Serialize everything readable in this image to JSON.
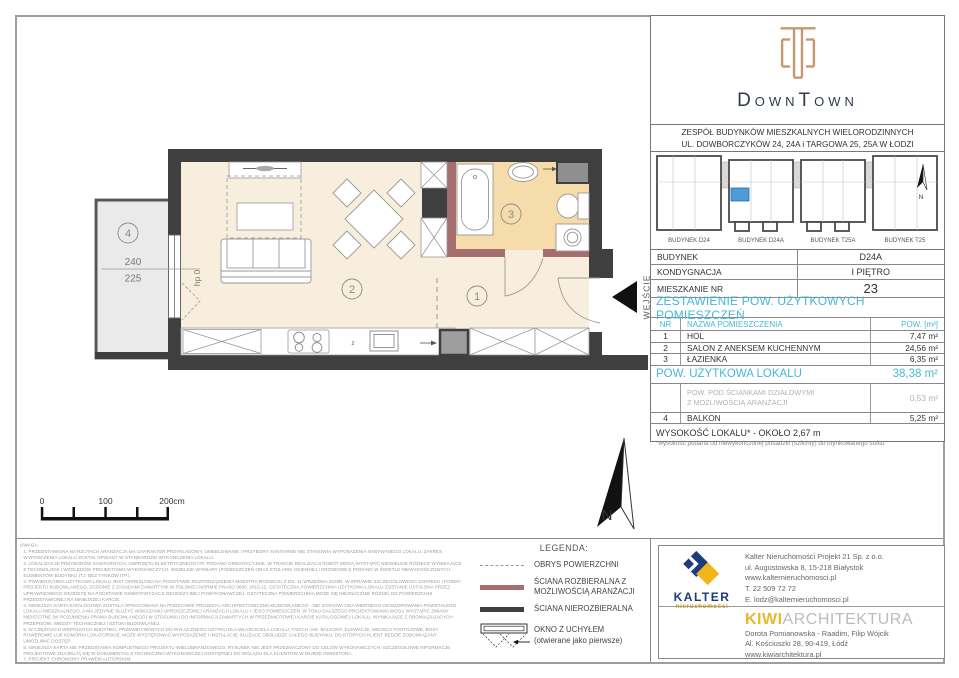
{
  "header": {
    "logo_title": "DownTown",
    "address_line1": "ZESPÓŁ BUDYNKÓW MIESZKALNYCH WIELORODZINNYCH",
    "address_line2": "UL. DOWBORCZYKÓW 24, 24A i TARGOWA 25, 25A W ŁODZI"
  },
  "site_plan": {
    "buildings": [
      {
        "label": "BUDYNEK D24"
      },
      {
        "label": "BUDYNEK D24A"
      },
      {
        "label": "BUDYNEK T25A"
      },
      {
        "label": "BUDYNEK T25"
      }
    ],
    "north_label": "N",
    "highlight_color": "#4f9bd8"
  },
  "unit_info": {
    "rows": [
      {
        "label": "BUDYNEK",
        "value": "D24A"
      },
      {
        "label": "KONDYGNACJA",
        "value": "I PIĘTRO"
      },
      {
        "label": "MIESZKANIE NR",
        "value": "23"
      }
    ]
  },
  "area_table": {
    "title": "ZESTAWIENIE POW. UŻYTKOWYCH POMIESZCZEŃ",
    "col_nr": "NR",
    "col_name": "NAZWA POMIESZCZENIA",
    "col_area": "POW. [m²]",
    "rooms": [
      {
        "nr": "1",
        "name": "HOL",
        "area": "7,47 m²"
      },
      {
        "nr": "2",
        "name": "SALON Z ANEKSEM KUCHENNYM",
        "area": "24,56 m²"
      },
      {
        "nr": "3",
        "name": "ŁAZIENKA",
        "area": "6,35 m²"
      }
    ],
    "total_label": "POW. UŻYTKOWA LOKALU",
    "total_value": "38,38 m²",
    "sub_label_line1": "POW. POD ŚCIANKAMI DZIAŁOWYMI",
    "sub_label_line2": "Z MOŻLIWOŚCIĄ ARANŻACJI",
    "sub_value": "0,53 m²",
    "balkon_nr": "4",
    "balkon_name": "BALKON",
    "balkon_value": "5,25 m²",
    "height_note": "WYSOKOŚĆ LOKALU* - OKOŁO 2,67 m",
    "height_footnote": "*wysokość podana od niewykończonej posadzki (szlichty) do otynkowanego sufitu"
  },
  "plan": {
    "room_hall": "1",
    "room_living": "2",
    "room_bath": "3",
    "room_balcony": "4",
    "entrance_label": "WEJŚCIE",
    "window_sill": "hp 0",
    "dim_top": "240",
    "dim_bottom": "225",
    "kitchen_z": "z",
    "north_label": "N",
    "scale_0": "0",
    "scale_100": "100",
    "scale_200": "200cm"
  },
  "legend": {
    "title": "LEGENDA:",
    "items": [
      "OBRYS POWIERZCHNI",
      "ŚCIANA ROZBIERALNA Z MOŻLIWOŚCIĄ ARANŻACJI",
      "ŚCIANA NIEROZBIERALNA",
      "OKNO Z UCHYŁEM",
      "(otwierane jako pierwsze)"
    ]
  },
  "notes": {
    "title": "UWAGA:",
    "items": [
      "1. PRZEDSTAWIONA NA RZUTACH ARANŻACJA MA CHARAKTER PRZYKŁADOWY. UMEBLOWANIE I PRZYBORY SANITARNE NIE STANOWIĄ WYPOSAŻENIA NABYWANEGO LOKALU. ZAKRES WYPOSAŻENIA LOKALU ZOSTAŁ OPISANY W STANDARDZIE WYKOŃCZENIA LOKALU.",
      "2. LOKALIZACJE PRZYBORÓW SANITARNYCH, OSPRZĘTU ELEKTRYCZNEGO ITP. PODANO ORIENTACYJNIE. W TRAKCIE REALIZACJI ROBÓT MOGĄ WYSTĄPIĆ NIEWIELKIE RÓŻNICE WYNIKAJĄCE Z TECHNOLOGII I WZGLĘDÓW PROJEKTOWO-WYKONAWCZYCH. WSZELKIE WYMIARY (POMIESZCZEŃ ORAZ STOLARKI OKIENNEJ I DRZWIOWEJ) PODANO W ŚWIETLE NIEWYKOŃCZONYCH ELEMENTÓW BUDYNKU (TJ. BEZ TYNKÓW ITP.).",
      "3. POWIERZCHNIA UŻYTKOWA LOKALU JEST OKREŚLONA NA PODSTAWIE ROZPORZĄDZENIA MINISTRA ROZWOJU Z DN. 11 WRZEŚNIA 2020R. W SPRAWIE SZCZEGÓŁOWEGO ZAKRESU I FORMY PROJEKTU BUDOWLANEGO, ZGODNIE Z ZASADAMI ZAWARTYMI W POLSKIEJ NORMIE PN-ISO 9836: 2015-12. OSTATECZNA POWIERZCHNIA UŻYTKOWA LOKALU ZOSTANIE USTALONA PRZEZ UPRAWNIONEGO GEODETĘ NA PODSTAWIE INWENTARYZACJI GEODEZYJNEJ POWYKONAWCZEJ. OSTATECZNA POWIERZCHNIA MOŻE SIĘ NIEZNACZNIE RÓŻNIĆ OD POWIERZCHNI PRZEDSTAWIONEJ NA NINIEJSZEJ KARCIE.",
      "4. NINIEJSZA KARTA KATALOGOWA ZOSTAŁA OPRACOWANA NA PODSTAWIE PROJEKTU ARCHITEKTONICZNO-BUDOWLANEGO - NIE STANOWI ONA WIERNEGO ODWZOROWANIA POWSTAŁEGO LOKALU MIESZKALNEGO, A MA JEDYNIE SŁUŻYĆ WSKAZANIU UPROSZCZONEJ ARANŻACJI LOKALU I JEGO POMIESZCZEŃ. W TOKU DALSZEGO PROJEKTOWANIA MOGĄ WYSTĄPIĆ ZMIANY NIEISTOTNE (W ROZUMIENIU PRAWA BUDOWLANEGO) W STOSUNKU DO INFORMACJI ZAWARTYCH W PRZEDMIOTOWEJ KARCIE KATALOGOWEJ LOKALU, WYNIKAJĄCE Z OBOWIĄZUJĄCYCH PRZEPISÓW, WIEDZY TECHNICZNEJ I SZTUKI BUDOWLANEJ.",
      "5. W CZĘŚCIACH WSPÓLNYCH BUDYNKU, PRZEWIDYWANYCH DO WYŁĄCZNEGO UŻYTKU DLA WŁAŚCICIELA LOKALU, TAKICH JAK: BALKONY, ELEWACJE, MIEJSCA POSTOJOWE, BOXY ROWEROWE LUB KOMÓRKI LOKATORSKIE, MOŻE WYSTĘPOWAĆ WYPOSAŻENIE I INSTALACJE SŁUŻĄCE OBSŁUDZE CAŁEGO BUDYNKU, DO KTÓRYCH KLIENT BĘDZIE ZOBOWIĄZANY UMOŻLIWIĆ DOSTĘP.",
      "6. NINIEJSZA KARTA NIE PRZEDSTAWIA KOMPLETNEGO PROJEKTU WIELOBRANŻOWEGO. RYSUNEK NIE JEST PRZEZNACZONY DO CELÓW WYKONAWCZYCH. SZCZEGÓŁOWE INFORMACJE PROJEKTOWE ZNAJDUJĄ SIĘ W DOKUMENTACJI TECHNICZNO-WYKONAWCZEJ DOSTĘPNEJ DO WGLĄDU DLA KLIENTÓW W BIURZE INWESTORA.",
      "7. PROJEKT CHRONIONY PRAWEM AUTORSKIM."
    ]
  },
  "kalter": {
    "name": "KALTER",
    "sub": "nieruchomości",
    "lines": [
      "Kalter Nieruchomości Projekt 21 Sp. z o.o.",
      "ul. Augustowska 8, 15-218 Białystok",
      "www.kalternieruchomosci.pl",
      "T. 22 509 72 72",
      "E. lodz@kalternieruchomosci.pl"
    ]
  },
  "kiwi": {
    "name_accent": "KIWI",
    "name_rest": "ARCHITEKTURA",
    "lines": [
      "Dorota Pomianowska - Raadim, Filip Wójcik",
      "Al. Kościuszki 28, 90-419, Łódź",
      "www.kiwiarchitektura.pl"
    ]
  },
  "colors": {
    "accent_blue": "#45b8d9",
    "wall_dark": "#3f3f3f",
    "wall_removable": "#a56e6e",
    "floor_main": "#f8eedd",
    "floor_bath": "#f7dcab",
    "floor_balcony": "#eaeaea",
    "logo_gold": "#c49a6c",
    "logo_navy": "#2e3b4e",
    "kalter_navy": "#1d3c7c",
    "kalter_yellow": "#f3b517",
    "kiwi_yellow": "#e8b832"
  }
}
